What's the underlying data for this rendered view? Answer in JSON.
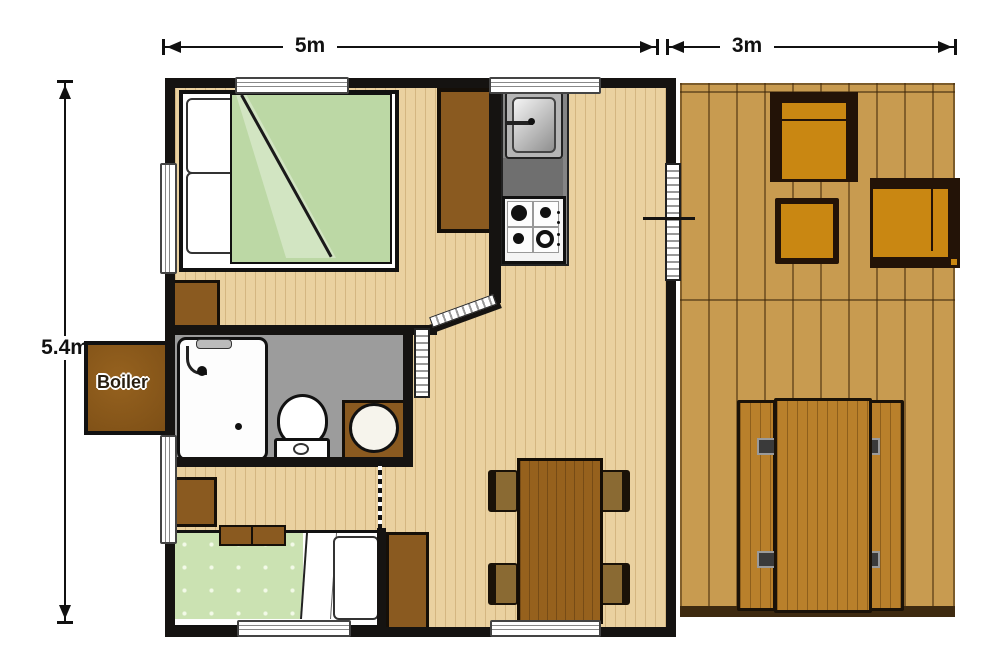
{
  "scene": {
    "type": "cabin-floor-plan",
    "background": "#ffffff"
  },
  "dimensions": {
    "top_left_width": "5m",
    "top_right_width": "3m",
    "left_height": "5.4m"
  },
  "boiler": {
    "label": "Boiler"
  },
  "palette": {
    "wall": "#151311",
    "interior_floor": "#ead1a0",
    "deck_floor": "#c89b50",
    "bathroom_floor": "#9c9c9c",
    "furniture_brown": "#8a5a20",
    "dining_table_brown": "#96611d",
    "deck_cushion_orange": "#c98712",
    "deck_frame_dark": "#231307",
    "bed_green": "#bcd8a5",
    "counter_gray": "#858585"
  },
  "rooms": {
    "bedroom_double": {
      "name": "double bedroom",
      "furniture": [
        "double-bed",
        "two-pillows",
        "green-duvet",
        "nightstand",
        "wardrobe"
      ]
    },
    "kitchen": {
      "name": "kitchen",
      "furniture": [
        "sink",
        "counter",
        "gas-stove"
      ]
    },
    "bathroom": {
      "name": "bathroom",
      "furniture": [
        "shower",
        "toilet",
        "washbasin"
      ]
    },
    "bedroom_single": {
      "name": "single bedroom",
      "furniture": [
        "single-bed",
        "pillow",
        "nightstand",
        "cushions"
      ]
    },
    "living": {
      "name": "living-dining area",
      "furniture": [
        "dining-table",
        "four-chairs",
        "wardrobe"
      ]
    },
    "deck": {
      "name": "terrace deck",
      "furniture": [
        "armchair-top",
        "armchair-right",
        "side-table",
        "picnic-table",
        "bench-left",
        "bench-right"
      ]
    }
  }
}
